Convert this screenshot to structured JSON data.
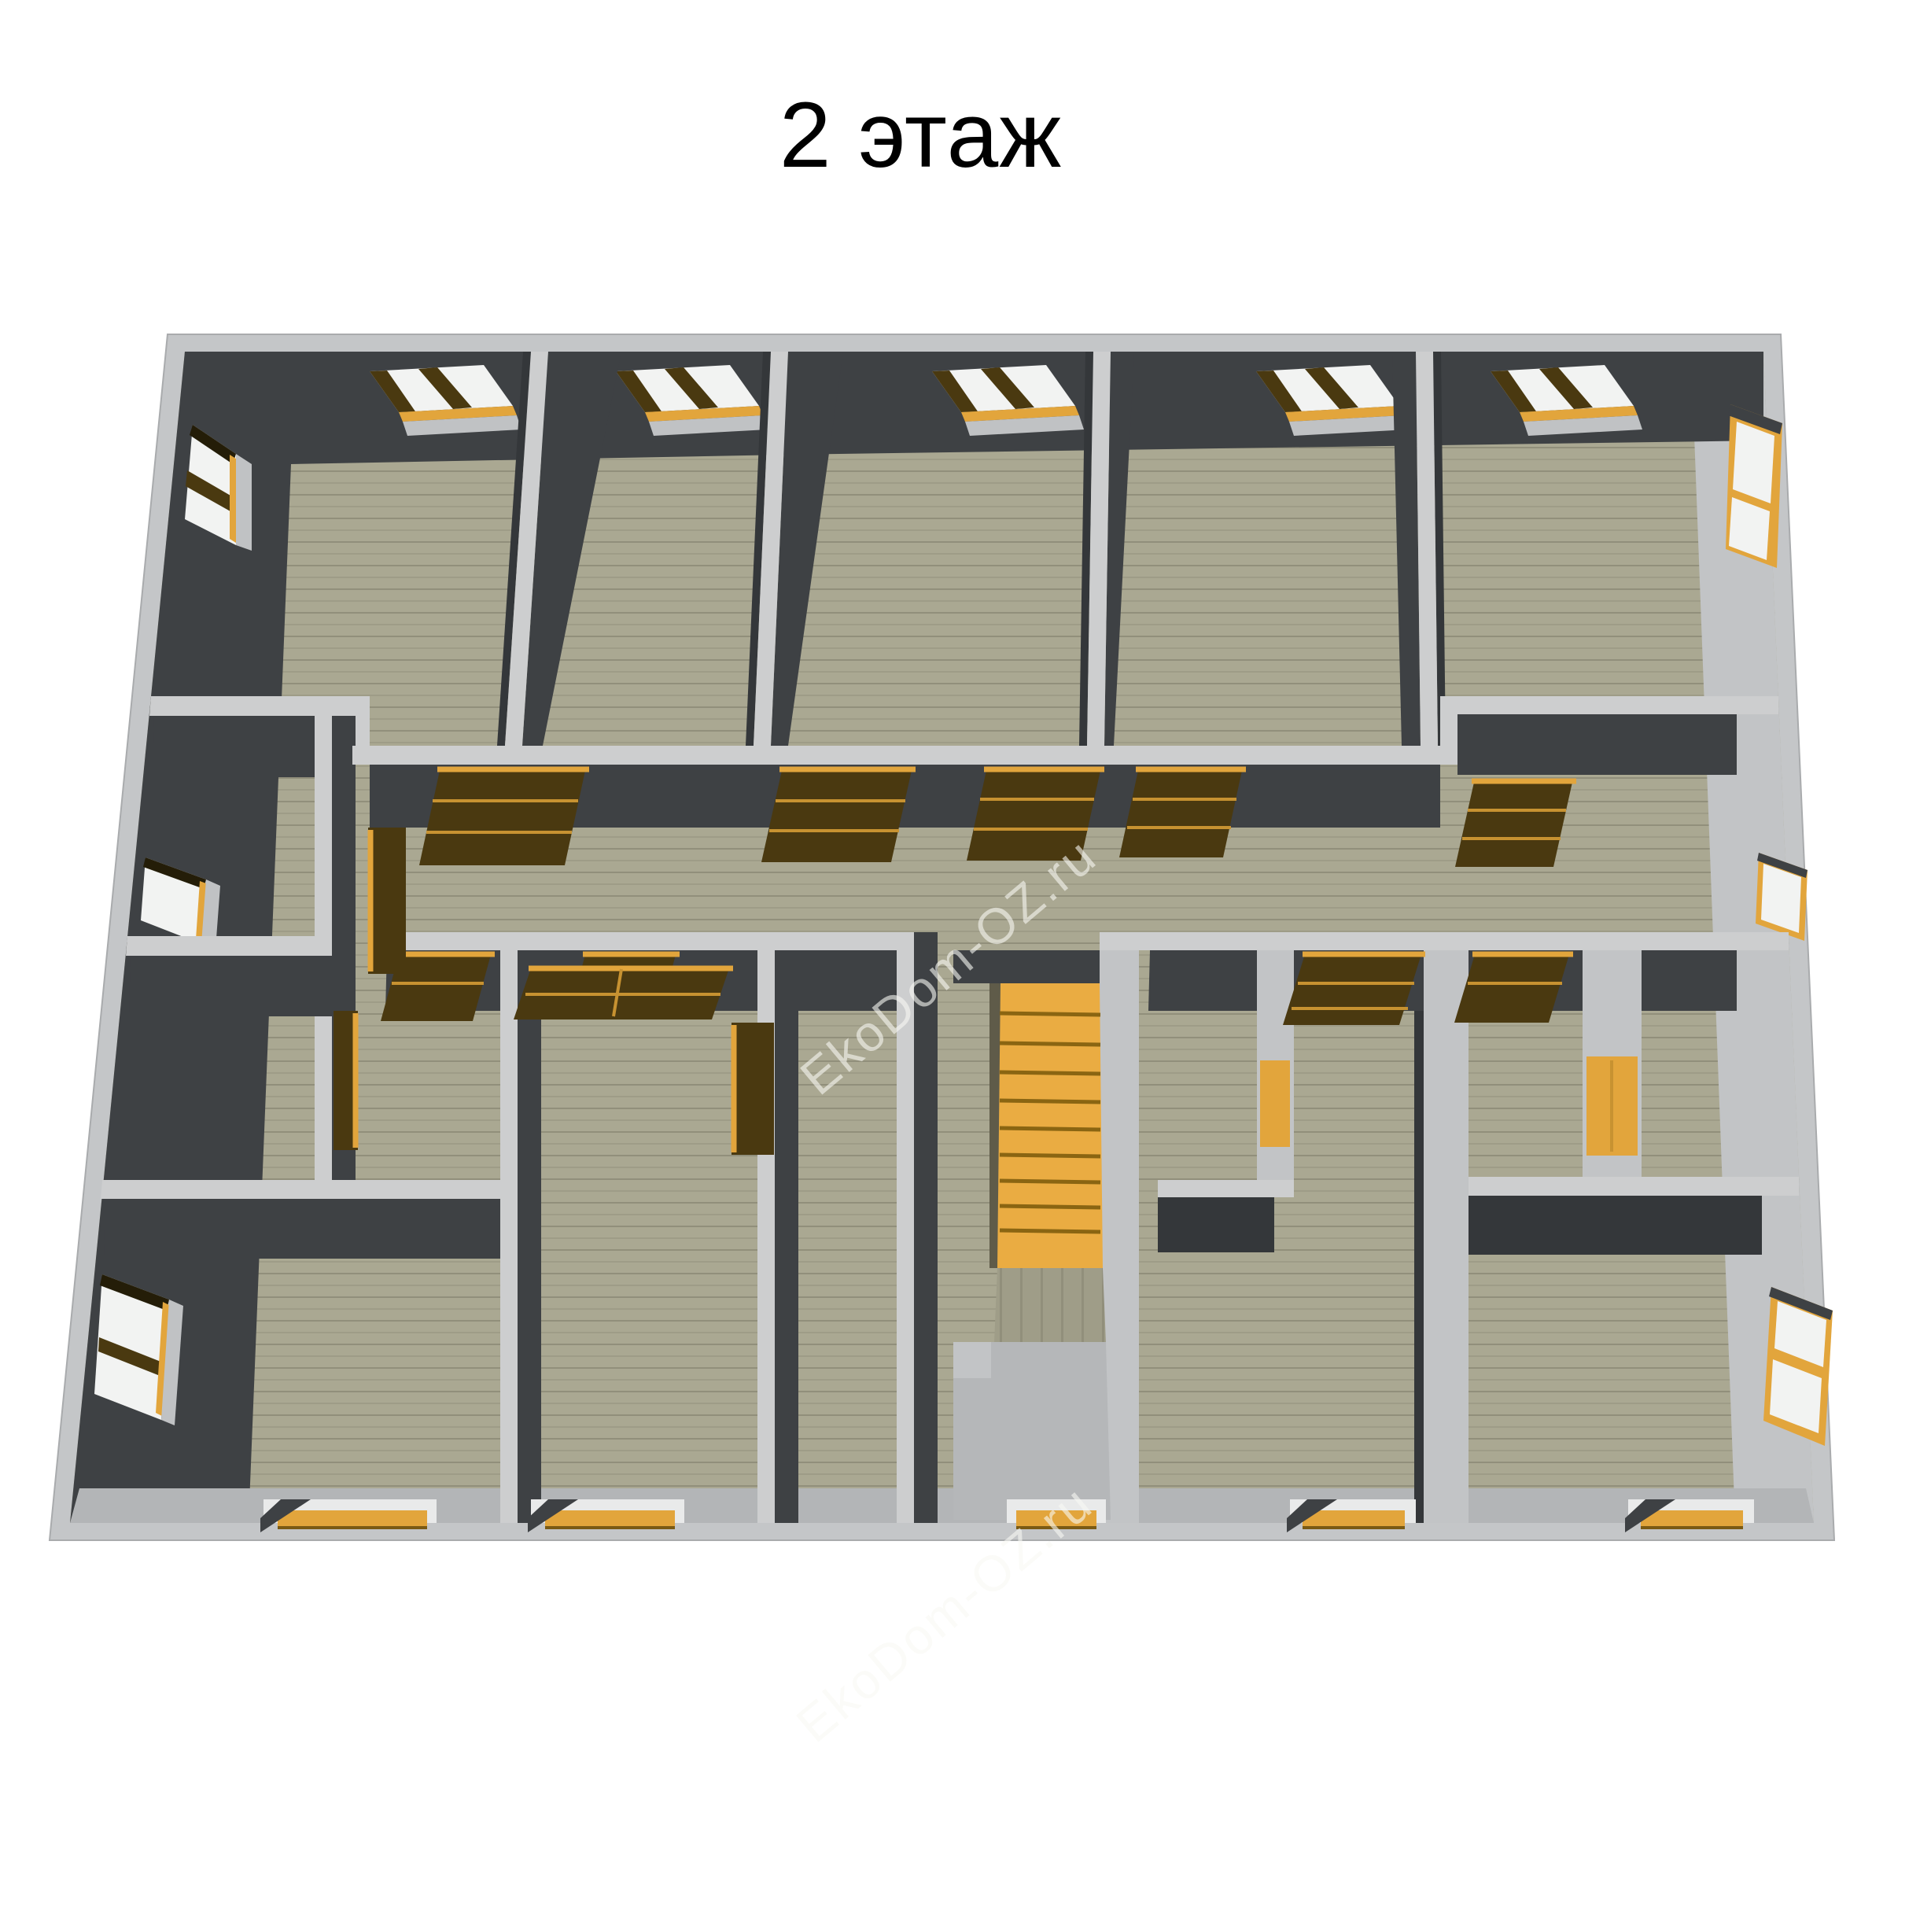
{
  "title": "2 этаж",
  "watermark": {
    "text": "EkoDom-OZ.ru"
  },
  "scene": {
    "description": "3D top-down cutaway render of the second floor of a timber house",
    "floor_label": "2 этаж",
    "top_row_rooms": 5,
    "skylight_windows_top_wall": 5,
    "windows_left_wall": 3,
    "windows_right_wall": 3,
    "open_wood_doors_visible": 13,
    "closets_with_wood_doors": 2,
    "staircase": {
      "location": "bottom-center",
      "visible_steps": 9
    },
    "bottom_wall_openings": 5
  },
  "colors": {
    "band": "#c4c6c8",
    "wallTop": "#cdcecf",
    "wallDark": "#3e4144",
    "wallDark2": "#34373a",
    "wallLit": "#c2c4c6",
    "wallLit2": "#b3b5b7",
    "pane": "#f2f3f2",
    "wood": "#e2a53c",
    "woodDark": "#4a3910",
    "woodTrim": "#c79231",
    "stair": "#eaac42",
    "stepLine": "#8a6512",
    "landing": "#b5b7b9",
    "floor1": "#aaa892",
    "floor2": "#9f9d88",
    "floorLine": "#918f7b",
    "watermark": "rgba(248,248,244,0.6)"
  }
}
